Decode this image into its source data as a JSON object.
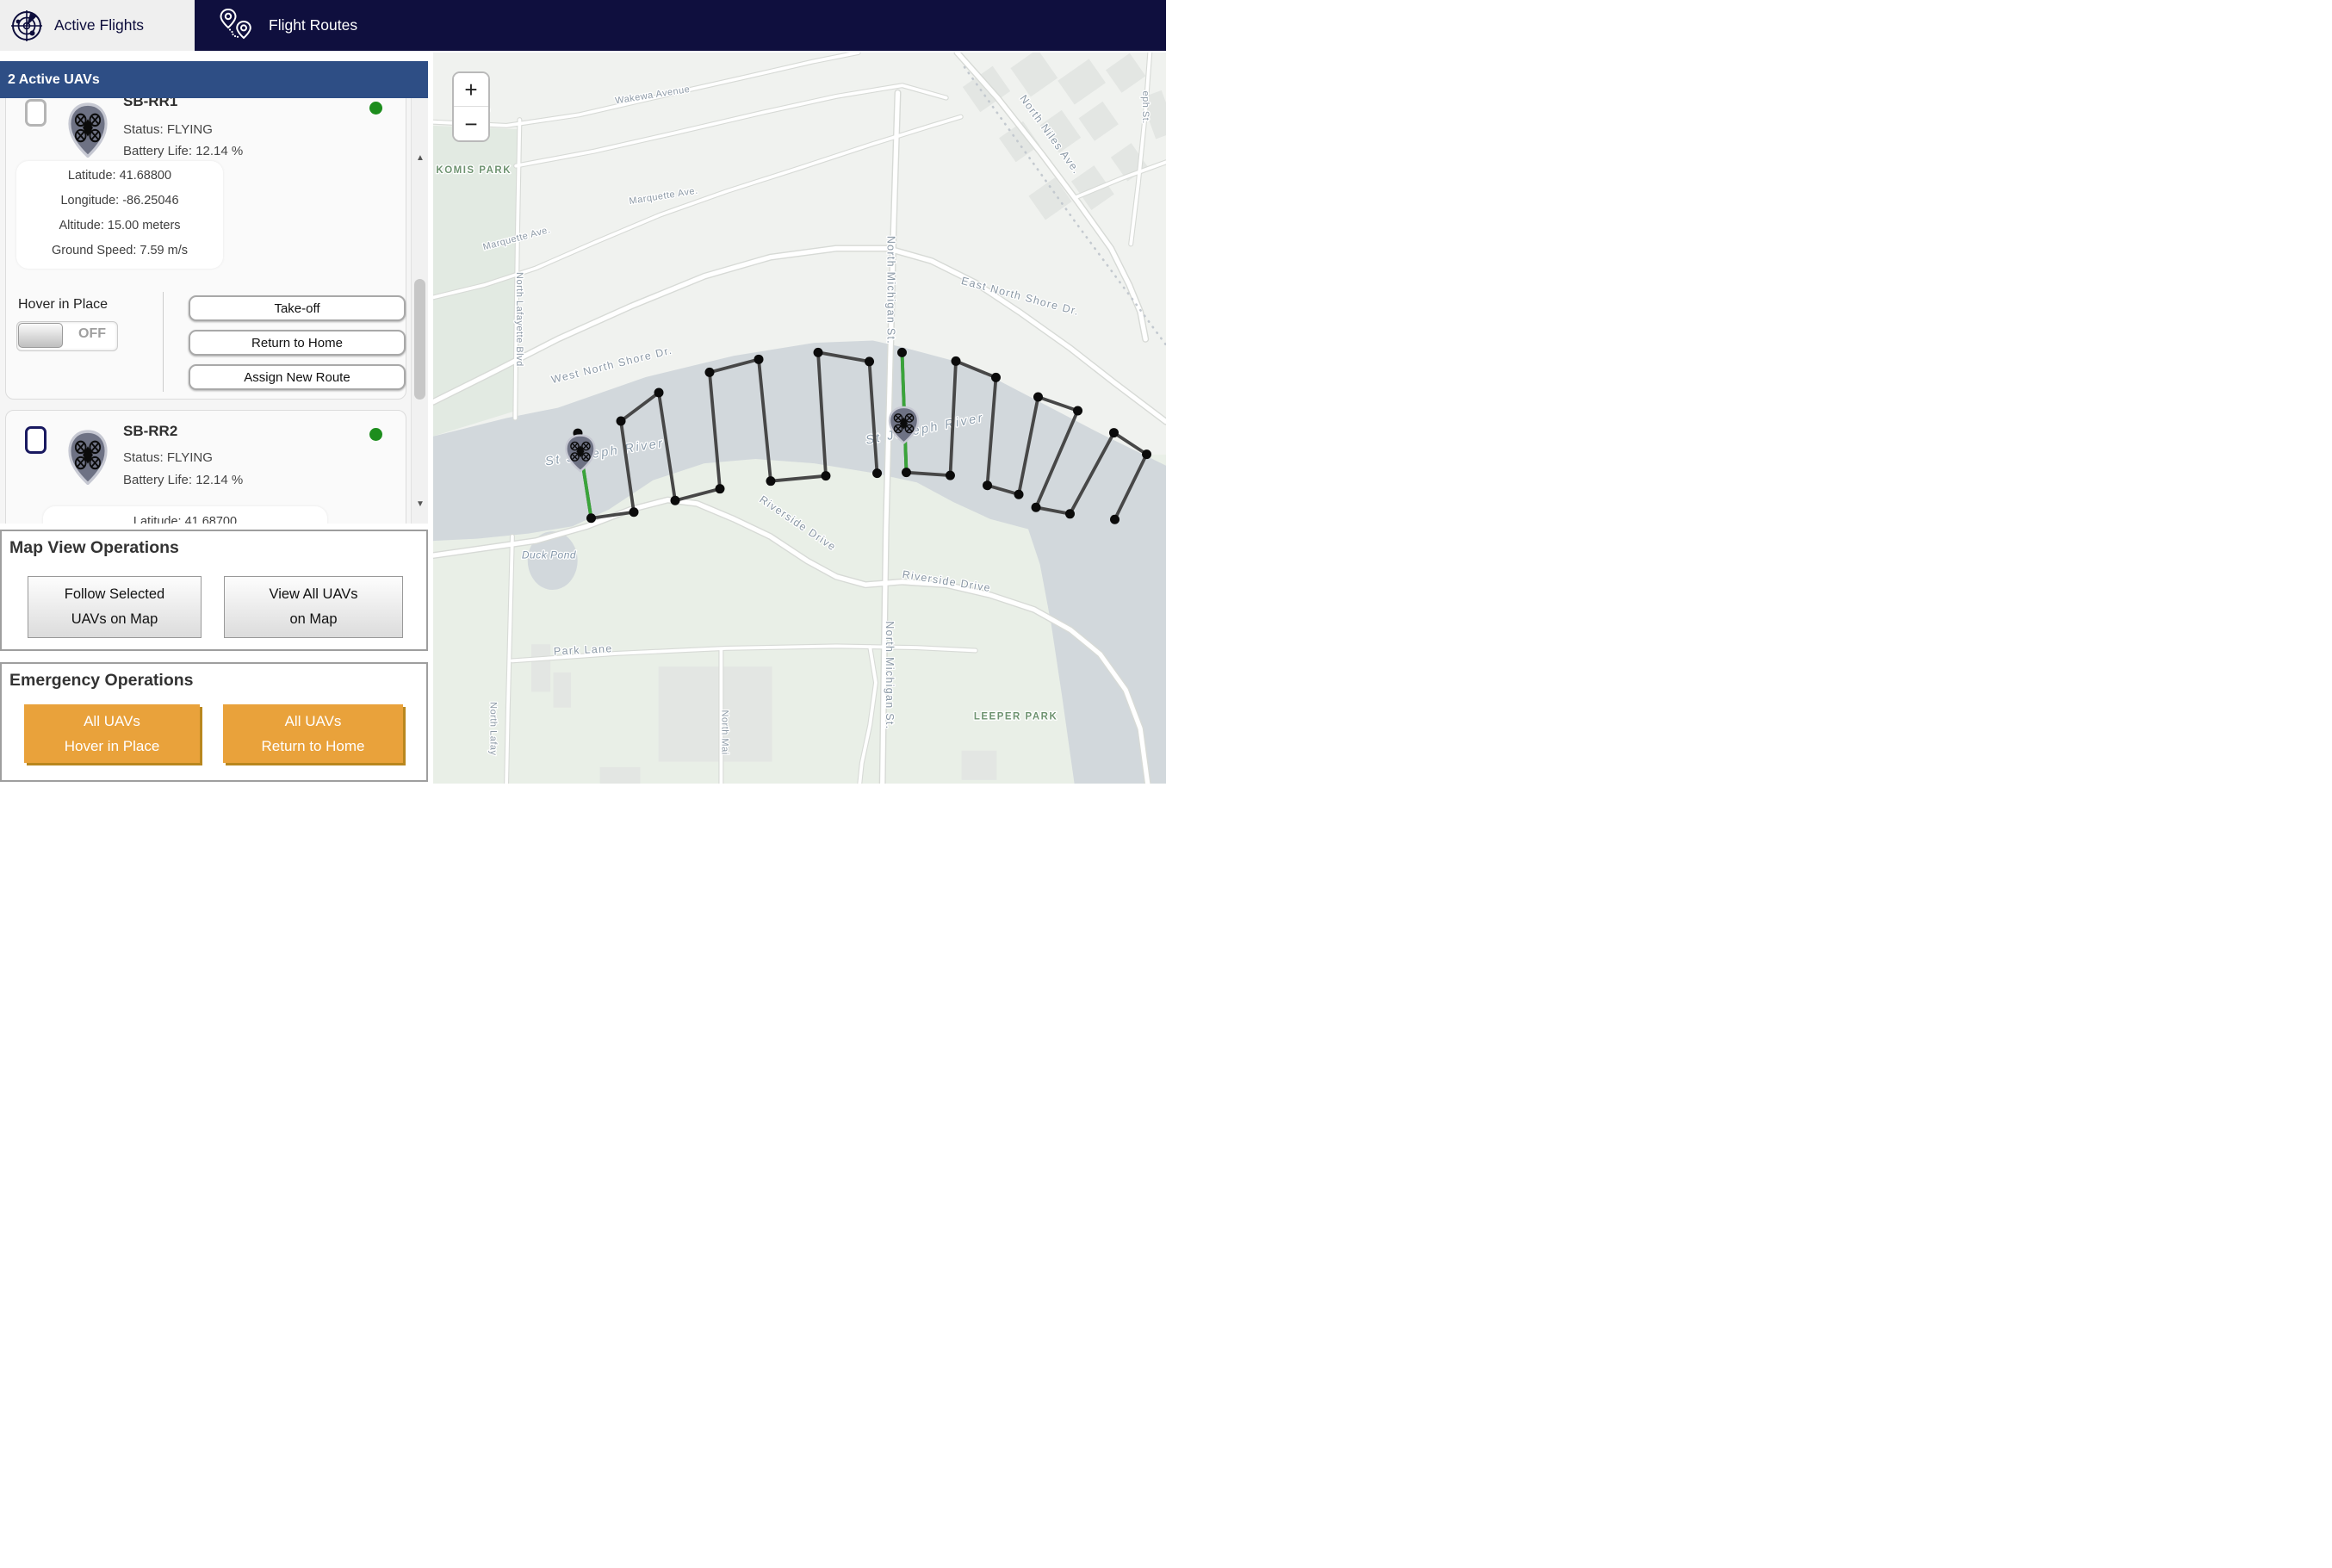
{
  "nav": {
    "tabs": [
      {
        "label": "Active Flights",
        "icon": "radar-icon",
        "active": true
      },
      {
        "label": "Flight Routes",
        "icon": "route-pins-icon",
        "active": false
      }
    ]
  },
  "sidebar": {
    "header": "2 Active UAVs",
    "scrollbar": {
      "up": "▲",
      "down": "▼"
    },
    "uavs": [
      {
        "name": "SB-RR1",
        "status": "Status: FLYING",
        "battery": "Battery Life: 12.14 %",
        "telemetry": [
          "Latitude: 41.68800",
          "Longitude: -86.25046",
          "Altitude: 15.00 meters",
          "Ground Speed: 7.59 m/s"
        ],
        "hover_label": "Hover in Place",
        "toggle": "OFF",
        "buttons": [
          "Take-off",
          "Return to Home",
          "Assign New Route"
        ]
      },
      {
        "name": "SB-RR2",
        "status": "Status: FLYING",
        "battery": "Battery Life: 12.14 %",
        "telemetry_partial": "Latitude: 41.68700"
      }
    ],
    "map_ops": {
      "title": "Map View Operations",
      "buttons": [
        "Follow Selected\nUAVs on Map",
        "View All UAVs\non Map"
      ]
    },
    "emergency": {
      "title": "Emergency Operations",
      "buttons": [
        "All UAVs\nHover in Place",
        "All UAVs\nReturn to Home"
      ]
    }
  },
  "map": {
    "zoom_in": "+",
    "zoom_out": "−",
    "colors": {
      "nav_navy": "#0f0f3e",
      "header_blue": "#2e4e85",
      "emergency_orange": "#e9a23b",
      "status_green": "#1d8d1d",
      "route": "#474747",
      "active_leg": "#3aa43a",
      "water": "#d2d8dc"
    },
    "labels": [
      {
        "t": "Wakewa Avenue",
        "x": 0.3,
        "y": 0.062,
        "r": -9,
        "c": "street"
      },
      {
        "t": "Avenue",
        "x": 0.055,
        "y": 0.084,
        "r": -6,
        "c": "street"
      },
      {
        "t": "KOMIS PARK",
        "x": 0.004,
        "y": 0.165,
        "r": 0,
        "c": "park",
        "anchor": "start"
      },
      {
        "t": "Marquette Ave.",
        "x": 0.315,
        "y": 0.2,
        "r": -9,
        "c": "street"
      },
      {
        "t": "Marquette Ave.",
        "x": 0.115,
        "y": 0.258,
        "r": -15,
        "c": "street"
      },
      {
        "t": "West North Shore Dr.",
        "x": 0.245,
        "y": 0.432,
        "r": -14,
        "c": "street-lg"
      },
      {
        "t": "East North Shore Dr.",
        "x": 0.8,
        "y": 0.338,
        "r": 15,
        "c": "street-lg"
      },
      {
        "t": "North Niles Ave.",
        "x": 0.838,
        "y": 0.115,
        "r": 54,
        "c": "street-lg"
      },
      {
        "t": "eph St.",
        "x": 0.968,
        "y": 0.075,
        "r": 90,
        "c": "street"
      },
      {
        "t": "North Lafayette Blvd",
        "x": 0.114,
        "y": 0.365,
        "r": 90,
        "c": "street"
      },
      {
        "t": "St Joseph River",
        "x": 0.235,
        "y": 0.552,
        "r": -9,
        "c": "water-lg"
      },
      {
        "t": "St Joseph River",
        "x": 0.672,
        "y": 0.52,
        "r": -11,
        "c": "water-lg"
      },
      {
        "t": "Riverside Drive",
        "x": 0.495,
        "y": 0.648,
        "r": 34,
        "c": "street-lg"
      },
      {
        "t": "Riverside Drive",
        "x": 0.7,
        "y": 0.728,
        "r": 9,
        "c": "street-lg"
      },
      {
        "t": "Duck Pond",
        "x": 0.158,
        "y": 0.692,
        "r": 0,
        "c": "water"
      },
      {
        "t": "Park Lane",
        "x": 0.205,
        "y": 0.822,
        "r": -3,
        "c": "street-lg"
      },
      {
        "t": "North Michigan St.",
        "x": 0.62,
        "y": 0.325,
        "r": 90,
        "c": "street-lg"
      },
      {
        "t": "North Michigan St.",
        "x": 0.618,
        "y": 0.852,
        "r": 90,
        "c": "street-lg"
      },
      {
        "t": "North Mai",
        "x": 0.394,
        "y": 0.93,
        "r": 90,
        "c": "street"
      },
      {
        "t": "North Lafay",
        "x": 0.078,
        "y": 0.925,
        "r": 90,
        "c": "street"
      },
      {
        "t": "LEEPER PARK",
        "x": 0.795,
        "y": 0.912,
        "r": 0,
        "c": "park"
      }
    ],
    "routes": [
      {
        "name": "SB-RR1-route",
        "points": [
          [
            0.1974,
            0.5207
          ],
          [
            0.2156,
            0.6369
          ],
          [
            0.2738,
            0.6287
          ],
          [
            0.2562,
            0.5041
          ],
          [
            0.3079,
            0.4652
          ],
          [
            0.3302,
            0.6128
          ],
          [
            0.3913,
            0.5968
          ],
          [
            0.3772,
            0.4374
          ],
          [
            0.4442,
            0.4197
          ],
          [
            0.4606,
            0.5862
          ],
          [
            0.5358,
            0.5791
          ],
          [
            0.5253,
            0.4103
          ],
          [
            0.5952,
            0.4227
          ],
          [
            0.6058,
            0.5755
          ]
        ],
        "active_leg": [
          0,
          1
        ]
      },
      {
        "name": "SB-RR2-route",
        "points": [
          [
            0.6398,
            0.4103
          ],
          [
            0.6457,
            0.5744
          ],
          [
            0.7056,
            0.5785
          ],
          [
            0.7133,
            0.4221
          ],
          [
            0.7679,
            0.4445
          ],
          [
            0.7562,
            0.5921
          ],
          [
            0.7991,
            0.6045
          ],
          [
            0.8255,
            0.4711
          ],
          [
            0.8796,
            0.49
          ],
          [
            0.8226,
            0.6222
          ],
          [
            0.869,
            0.6311
          ],
          [
            0.9289,
            0.5201
          ],
          [
            0.9736,
            0.5496
          ],
          [
            0.9301,
            0.6387
          ]
        ],
        "active_leg": [
          0,
          1
        ]
      }
    ],
    "drones": [
      {
        "name": "SB-RR1",
        "x": 0.2009,
        "y": 0.5478
      },
      {
        "name": "SB-RR2",
        "x": 0.6422,
        "y": 0.5094
      }
    ]
  }
}
